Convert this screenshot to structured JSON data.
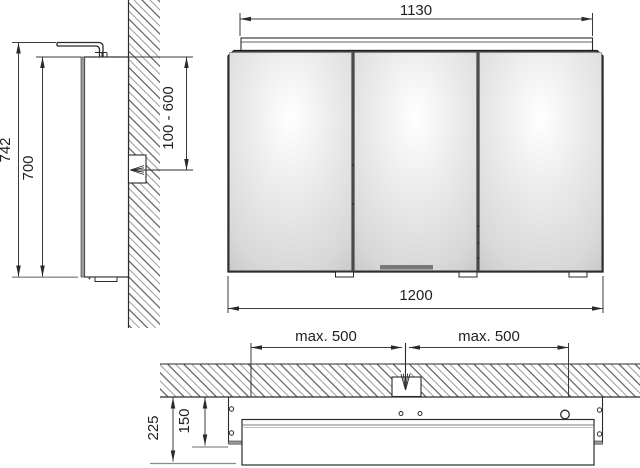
{
  "drawing": {
    "kind": "mirror cabinet with lighting – dimensional technical drawing (side view, front view, plan section)",
    "dimensions": {
      "side": {
        "total_height": "742",
        "cabinet_height": "700",
        "supply_range": "100 - 600"
      },
      "front": {
        "light_width": "1130",
        "cabinet_width": "1200"
      },
      "plan": {
        "max_left": "max. 500",
        "max_right": "max. 500",
        "total_depth": "225",
        "inset_depth": "150"
      }
    },
    "colors": {
      "line": "#2b2b2b",
      "dimension_line": "#3a3a3a",
      "hatch_dark": "#3c3c3c",
      "hatch_light": "#9c9c9c",
      "mirror_edge_gray": "#9b9b9b",
      "baseline_gray": "#8a8a8a",
      "mirror_highlight": "#ffffff",
      "mirror_shadow": "#c2c2c2",
      "cabinet_gap": "#4a4a4a"
    }
  }
}
